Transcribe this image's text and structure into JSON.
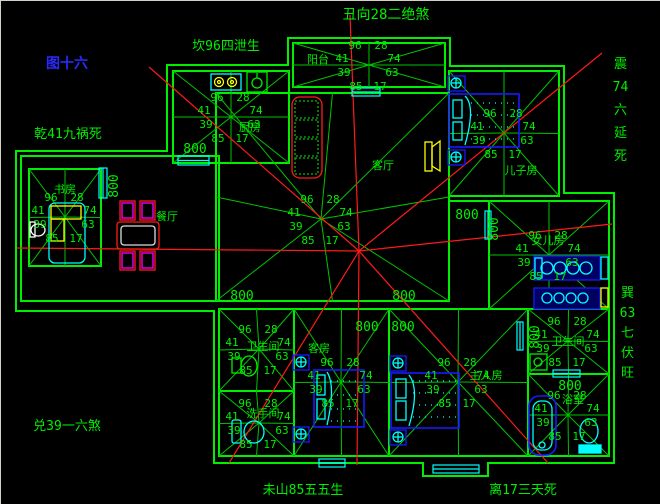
{
  "figure": {
    "label": "图十六"
  },
  "heading": {
    "top": "丑向28二绝煞"
  },
  "compass": {
    "kan": "坎96四泄生",
    "qian": "乾41九祸死",
    "zhen": "震74六延死",
    "xun": "巽63七伏旺",
    "dui": "兑39一六煞",
    "wei": "未山85五五生",
    "li": "离17三天死"
  },
  "star_numbers": {
    "tl": "96",
    "tr": "28",
    "l": "41",
    "r": "74",
    "bl": "39",
    "br": "63",
    "b2l": "85",
    "b2r": "17"
  },
  "dimension_label": "800",
  "rooms": {
    "kitchen": "厨房",
    "study": "书房",
    "balcony": "阳台",
    "dining": "餐厅",
    "living": "客厅",
    "son": "儿子房",
    "daughter": "女儿房",
    "bath1": "卫生间",
    "bath2": "洗手间",
    "guest": "客房",
    "master": "主人房",
    "bath3": "卫生间",
    "bath4": "浴室"
  },
  "colors": {
    "wall_green": "#00ee00",
    "ray_green": "#00c400",
    "analysis_red": "#ff1a1a",
    "fixture_cyan": "#00ffff",
    "furniture_blue": "#1a1aff",
    "accent_yellow": "#ffff00",
    "accent_magenta": "#ff00ff",
    "figure_blue": "#2a2aff",
    "background": "#000000"
  }
}
